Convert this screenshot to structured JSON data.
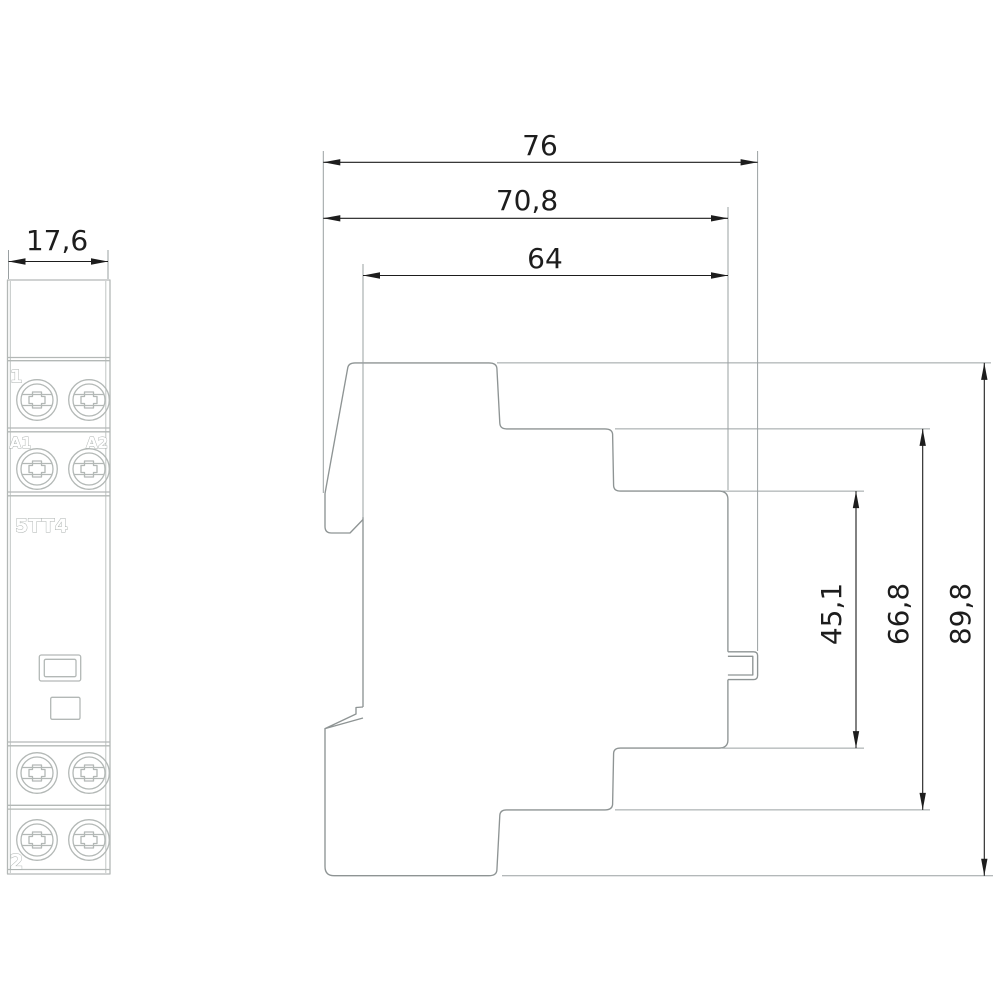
{
  "drawing": {
    "front_view": {
      "width_dim": "17,6",
      "terminal_label_top": "1",
      "coil_terminal_left": "A1",
      "coil_terminal_right": "A2",
      "model_label": "5TT4",
      "terminal_label_bottom": "2"
    },
    "side_view": {
      "overall_depth": "76",
      "upper_body_depth": "70,8",
      "front_section_depth": "64",
      "rail_recess_height": "45,1",
      "mid_section_height": "66,8",
      "overall_height": "89,8"
    },
    "colors": {
      "ink": "#1d1d1d",
      "side_outline": "#8e9494",
      "extension_line": "#9aa0a2",
      "front_outline": "#b3b8b6",
      "background": "#ffffff"
    }
  }
}
